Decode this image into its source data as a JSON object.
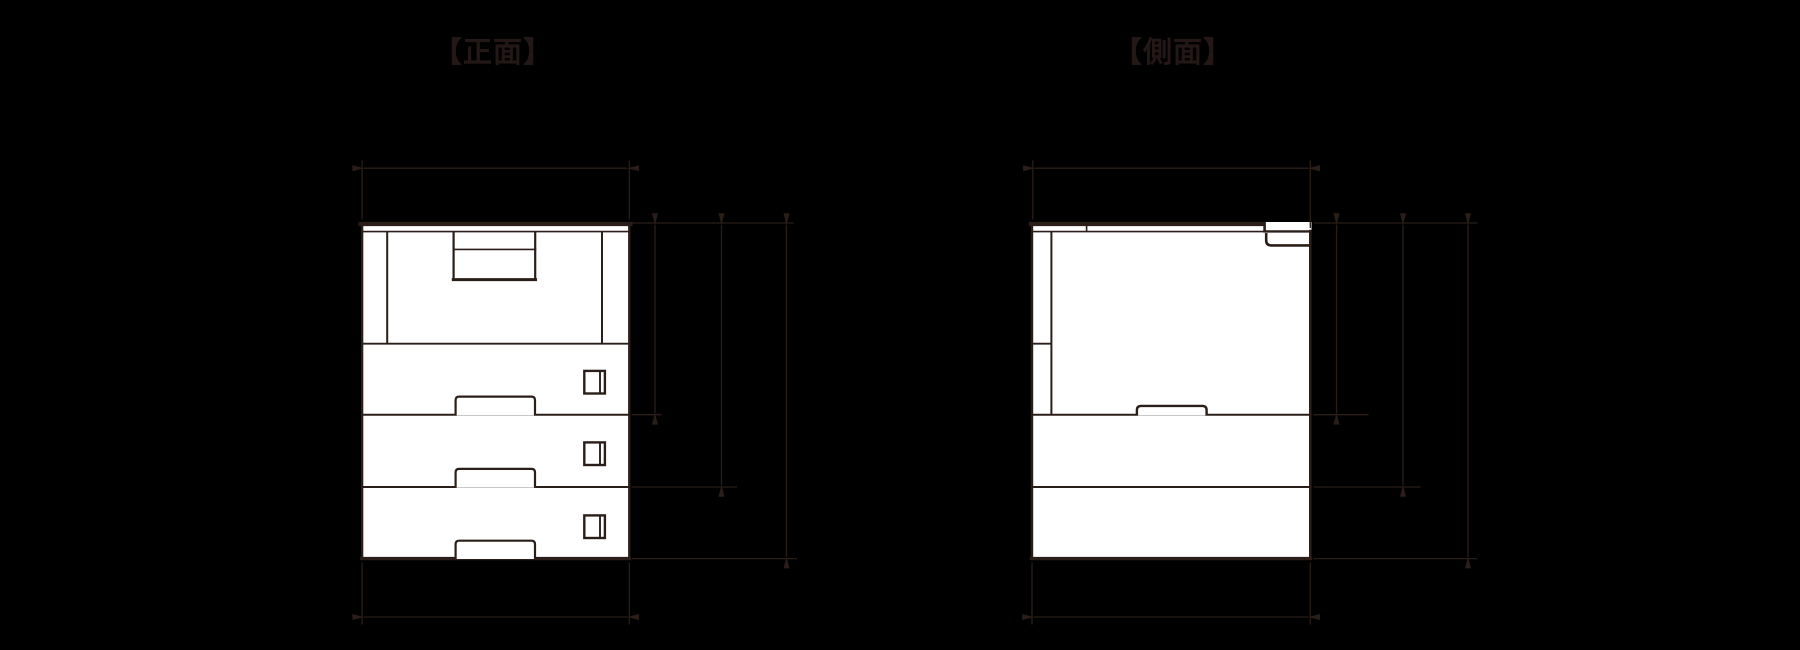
{
  "colors": {
    "background": "#000000",
    "line": "#2b1e18",
    "text": "#231815",
    "fill": "#ffffff"
  },
  "views": {
    "front": {
      "title": "【正面】"
    },
    "side": {
      "title": "【側面】"
    }
  }
}
